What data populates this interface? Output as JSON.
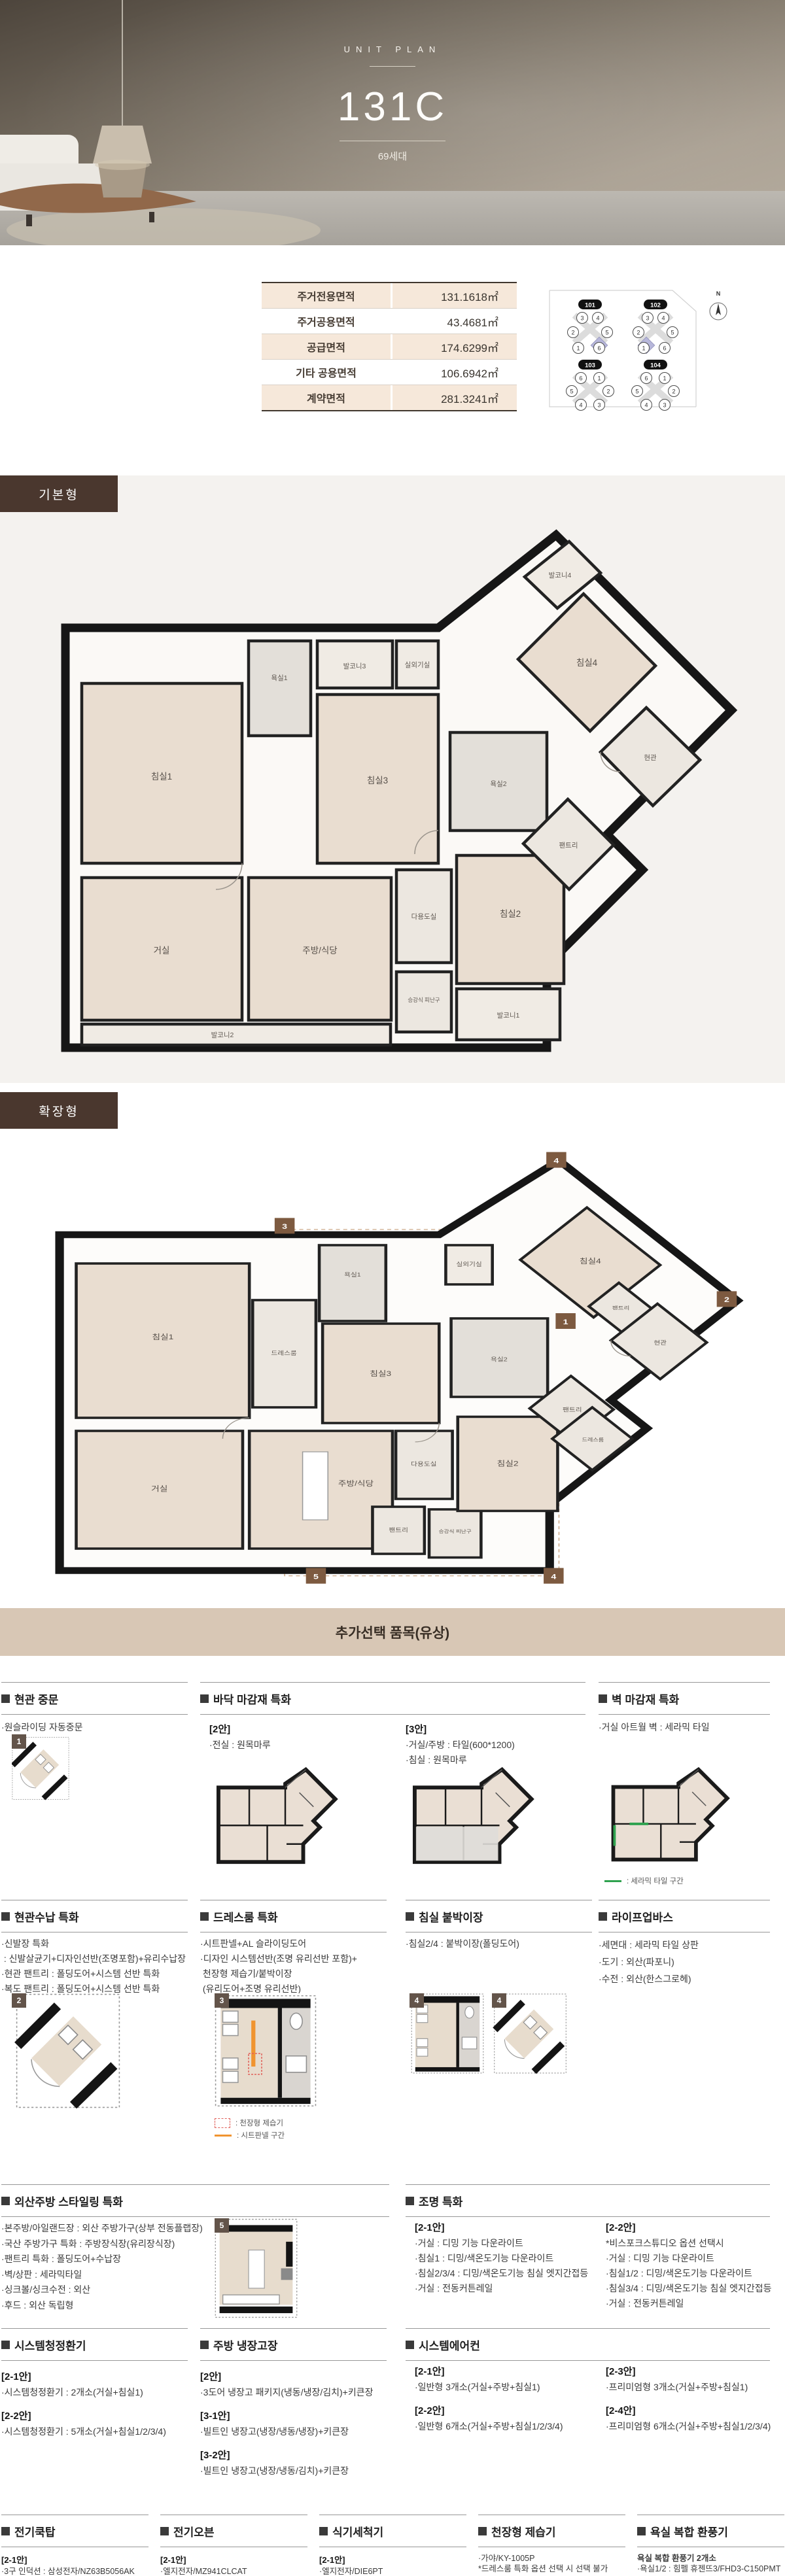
{
  "hero": {
    "eyebrow": "UNIT PLAN",
    "title": "131C",
    "units_badge": "69세대"
  },
  "area_table": {
    "rows": [
      {
        "label": "주거전용면적",
        "value": "131.1618㎡"
      },
      {
        "label": "주거공용면적",
        "value": "43.4681㎡"
      },
      {
        "label": "공급면적",
        "value": "174.6299㎡"
      },
      {
        "label": "기타 공용면적",
        "value": "106.6942㎡"
      },
      {
        "label": "계약면적",
        "value": "281.3241㎡"
      }
    ]
  },
  "site_plan": {
    "buildings": [
      "101",
      "102",
      "103",
      "104"
    ],
    "unit_numbers": [
      "1",
      "2",
      "3",
      "4",
      "5",
      "6"
    ],
    "compass": "N"
  },
  "plans": {
    "basic": {
      "label": "기본형",
      "rooms": [
        "침실1",
        "욕실1",
        "발코니3",
        "실외기실",
        "발코니4",
        "침실4",
        "침실3",
        "욕실2",
        "현관",
        "팬트리",
        "거실",
        "주방/식당",
        "다용도실",
        "침실2",
        "승강식 피난구",
        "발코니1",
        "발코니2"
      ]
    },
    "extended": {
      "label": "확장형",
      "rooms": [
        "침실1",
        "드레스룸",
        "욕실1",
        "침실3",
        "실외기실",
        "침실4",
        "팬트리",
        "욕실2",
        "현관",
        "팬트리",
        "거실",
        "주방/식당",
        "다용도실",
        "팬트리",
        "승강식 피난구",
        "침실2",
        "드레스룸"
      ],
      "markers": [
        "3",
        "4",
        "2",
        "1",
        "5",
        "4"
      ]
    }
  },
  "options": {
    "title": "추가선택 품목(유상)",
    "cards": {
      "entrance_door": {
        "title": "현관 중문",
        "lines": [
          "·원슬라이딩 자동중문"
        ],
        "marker": "1"
      },
      "floor_finish": {
        "title": "바닥 마감재 특화",
        "plan2_tag": "[2안]",
        "plan2_lines": [
          "·전실 : 원목마루"
        ],
        "plan3_tag": "[3안]",
        "plan3_lines": [
          "·거실/주방 : 타일(600*1200)",
          "·침실 : 원목마루"
        ]
      },
      "wall_finish": {
        "title": "벽 마감재 특화",
        "lines": [
          "·거실 아트월 벽 : 세라믹 타일"
        ],
        "legend": ": 세라믹 타일 구간"
      },
      "entrance_storage": {
        "title": "현관수납 특화",
        "marker": "2",
        "lines": [
          "·신발장 특화",
          " : 신발살균기+디자인선반(조명포함)+유리수납장",
          "·현관 팬트리 : 폴딩도어+시스템 선반 특화",
          "·복도 팬트리 : 폴딩도어+시스템 선반 특화"
        ]
      },
      "dressroom": {
        "title": "드레스룸 특화",
        "marker": "3",
        "lines": [
          "·시트판넬+AL 슬라이딩도어",
          "·디자인 시스템선반(조명 유리선반 포함)+",
          " 천장형 제습기/붙박이장",
          " (유리도어+조명 유리선반)"
        ],
        "legend_dehumidifier": ": 천장형 제습기",
        "legend_sheet": ": 시트판넬 구간"
      },
      "builtin_closet": {
        "title": "침실 붙박이장",
        "lines": [
          "·침실2/4 : 붙박이장(폴딩도어)"
        ],
        "marker": "4"
      },
      "life_up_bath": {
        "title": "라이프업바스",
        "lines": [
          "·세면대 : 세라믹 타일 상판",
          "·도기 : 외산(파포니)",
          "·수전 : 외산(한스그로헤)"
        ]
      },
      "kitchen_styling": {
        "title": "외산주방 스타일링 특화",
        "marker": "5",
        "lines": [
          "·본주방/아일랜드장 : 외산 주방가구(상부 전동플랩장)",
          "·국산 주방가구 특화 : 주방장식장(유리장식장)",
          "·팬트리 특화 : 폴딩도어+수납장",
          "·벽/상판 : 세라믹타일",
          "·싱크볼/싱크수전 : 외산",
          "·후드 : 외산 독립형"
        ]
      },
      "lighting": {
        "title": "조명 특화",
        "groups": [
          {
            "tag": "[2-1안]",
            "lines": [
              "·거실 : 디밍 기능 다운라이트",
              "·침실1 : 디밍/색온도기능 다운라이트",
              "·침실2/3/4 : 디밍/색온도기능 침실 엣지간접등",
              "·거실 : 전동커튼레일"
            ]
          },
          {
            "tag": "[2-2안]",
            "lines": [
              "*비스포크스튜디오 옵션 선택시",
              "·거실 : 디밍 기능 다운라이트",
              "·침실1/2 : 디밍/색온도기능 다운라이트",
              "·침실3/4 : 디밍/색온도기능 침실 엣지간접등",
              "·거실 : 전동커튼레일"
            ]
          }
        ]
      },
      "ventilation": {
        "title": "시스템청정환기",
        "groups": [
          {
            "tag": "[2-1안]",
            "lines": [
              "·시스템청정환기 : 2개소(거실+침실1)"
            ]
          },
          {
            "tag": "[2-2안]",
            "lines": [
              "·시스템청정환기 : 5개소(거실+침실1/2/3/4)"
            ]
          }
        ]
      },
      "fridge_cabinet": {
        "title": "주방 냉장고장",
        "groups": [
          {
            "tag": "[2안]",
            "lines": [
              "·3도어 냉장고 패키지(냉동/냉장/김치)+키큰장"
            ]
          },
          {
            "tag": "[3-1안]",
            "lines": [
              "·빌트인 냉장고(냉장/냉동/냉장)+키큰장"
            ]
          },
          {
            "tag": "[3-2안]",
            "lines": [
              "·빌트인 냉장고(냉장/냉동/김치)+키큰장"
            ]
          }
        ]
      },
      "aircon": {
        "title": "시스템에어컨",
        "groups": [
          {
            "tag": "[2-1안]",
            "lines": [
              "·일반형 3개소(거실+주방+침실1)"
            ]
          },
          {
            "tag": "[2-2안]",
            "lines": [
              "·일반형 6개소(거실+주방+침실1/2/3/4)"
            ]
          },
          {
            "tag": "[2-3안]",
            "lines": [
              "·프리미엄형 3개소(거실+주방+침실1)"
            ]
          },
          {
            "tag": "[2-4안]",
            "lines": [
              "·프리미엄형 6개소(거실+주방+침실1/2/3/4)"
            ]
          }
        ]
      },
      "cooktop": {
        "title": "전기쿡탑",
        "groups": [
          {
            "tag": "[2-1안]",
            "lines": [
              "·3구 인덕션 : 삼성전자/NZ63B5056AK"
            ]
          },
          {
            "tag": "[2-2안]",
            "lines": [
              "·4구 인덕션 : 밀레/KM7363FL"
            ]
          }
        ]
      },
      "oven": {
        "title": "전기오븐",
        "groups": [
          {
            "tag": "[2-1안]",
            "lines": [
              "·엘지전자/MZ941CLCAT"
            ]
          },
          {
            "tag": "[2-2안]",
            "lines": [
              "·밀레/H7440BM"
            ]
          }
        ]
      },
      "dishwasher": {
        "title": "식기세척기",
        "groups": [
          {
            "tag": "[2-1안]",
            "lines": [
              "·엘지전자/DIE6PT"
            ]
          },
          {
            "tag": "[2-2안]",
            "lines": [
              "·밀레/G7964SCVI"
            ]
          }
        ]
      },
      "dehumidifier": {
        "title": "천장형 제습기",
        "lines": [
          "·가야/KY-1005P",
          "*드레스룸 특화 옵션 선택 시 선택 불가"
        ]
      },
      "bath_fan": {
        "title": "욕실 복합 환풍기",
        "lines": [
          "욕실 복합 환풍기 2개소",
          "·욕실1/2 : 힘펠 휴젠뜨3/FHD3-C150PMT"
        ]
      }
    }
  },
  "colors": {
    "brand_brown": "#4a372e",
    "bar_beige": "#d8c7b5",
    "table_beige": "#f6e8da",
    "highlight_purple": "#b7b7da",
    "legend_green": "#2fa24f",
    "legend_orange": "#f09430",
    "legend_red": "#e0605a"
  }
}
